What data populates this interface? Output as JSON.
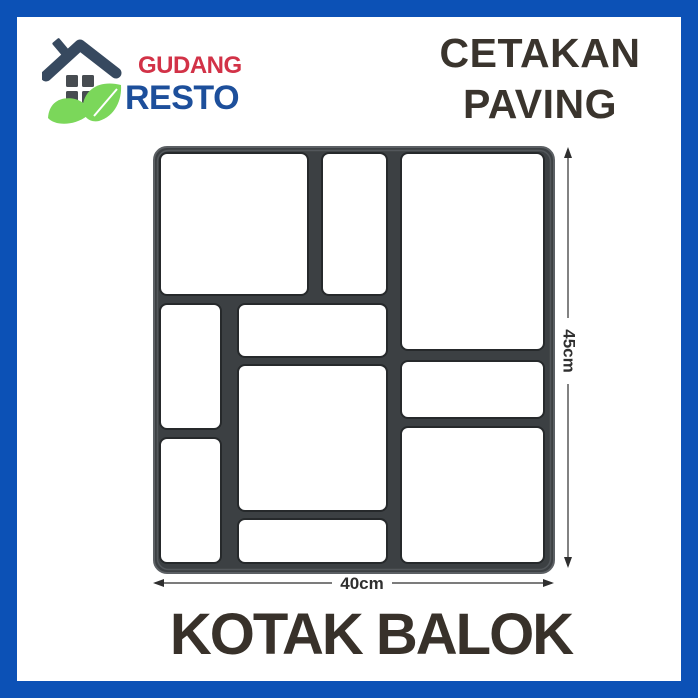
{
  "page": {
    "background": "#ffffff",
    "border_color": "#0c51b6"
  },
  "logo": {
    "name_top": "GUDANG",
    "name_bottom": "RESTO",
    "colors": {
      "name_top": "#d23247",
      "name_bottom": "#1d4f9b",
      "roof": "#37495f",
      "window": "#474c51",
      "leaf": "#7bd75a"
    }
  },
  "title": {
    "line1": "CETAKAN",
    "line2": "PAVING",
    "color": "#3a342d"
  },
  "footer": {
    "product_name": "KOTAK BALOK",
    "color": "#38312a"
  },
  "diagram": {
    "height_label": "45cm",
    "width_label": "40cm",
    "mold_color": "#3c4043",
    "mold_edge_color": "#5c6064",
    "cell_fill": "#ffffff",
    "cell_edge_color": "#26292b",
    "dimension_color": "#2f2f2f",
    "cells": [
      {
        "x": 20,
        "y": 18,
        "w": 148,
        "h": 142
      },
      {
        "x": 182,
        "y": 18,
        "w": 65,
        "h": 142
      },
      {
        "x": 261,
        "y": 18,
        "w": 143,
        "h": 197
      },
      {
        "x": 20,
        "y": 169,
        "w": 61,
        "h": 125
      },
      {
        "x": 98,
        "y": 169,
        "w": 149,
        "h": 53
      },
      {
        "x": 98,
        "y": 230,
        "w": 149,
        "h": 146
      },
      {
        "x": 261,
        "y": 226,
        "w": 143,
        "h": 57
      },
      {
        "x": 20,
        "y": 303,
        "w": 61,
        "h": 125
      },
      {
        "x": 98,
        "y": 384,
        "w": 149,
        "h": 44
      },
      {
        "x": 261,
        "y": 292,
        "w": 143,
        "h": 136
      }
    ]
  }
}
